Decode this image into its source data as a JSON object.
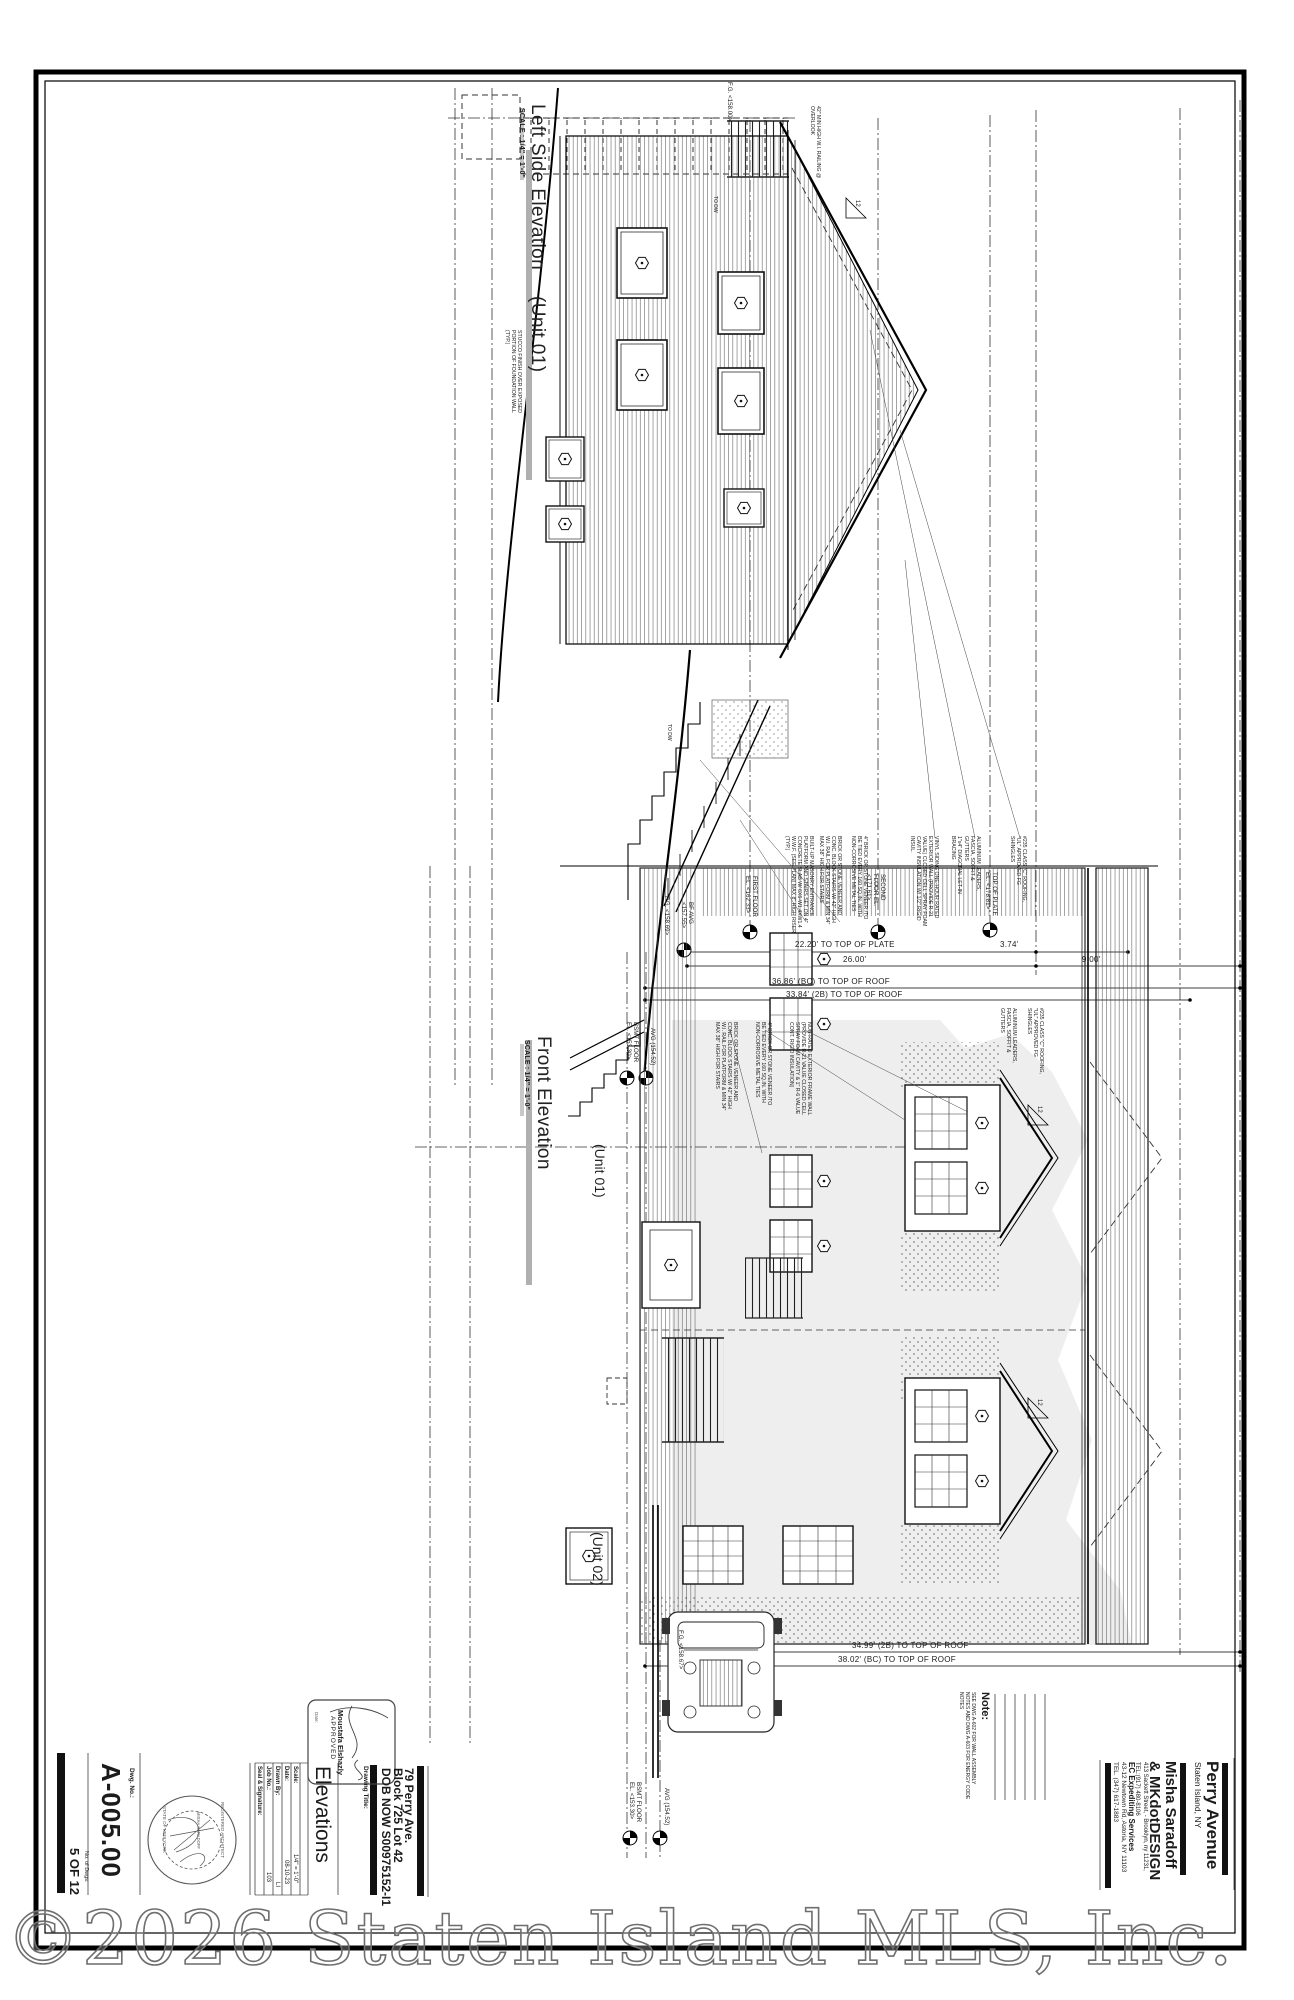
{
  "colors": {
    "ink": "#1b1b1b",
    "silhouette": "#e0e0e0",
    "watermark_gray": "#6e6e6e"
  },
  "watermark": "©2026 Staten Island MLS, Inc.",
  "elevations": {
    "left": {
      "title": "Left Side Elevation",
      "unit": "(Unit 01)",
      "scale": "SCALE : 1/4\" = 1'-0\""
    },
    "front": {
      "title": "Front Elevation",
      "scale": "SCALE : 1/4\" = 1'-0\"",
      "unit1": "(Unit 01)",
      "unit2": "(Unit 02)"
    }
  },
  "dims": {
    "plate": "22.20' TO TOP OF PLATE",
    "overall": "26.00'",
    "bc_roof": "36.86' (BC) TO TOP OF ROOF",
    "b2_roof": "33.84' (2B) TO TOP OF ROOF",
    "d374": "3.74'",
    "d900": "9.00'",
    "front_2b": "34.99' (2B) TO TOP OF ROOF",
    "front_bc": "38.02' (BC) TO TOP OF ROOF"
  },
  "levels": {
    "first": "FIRST FLOOR EL. <162.33>",
    "second": "SECOND FLOOR EL. <171.61>",
    "plate": "TOP OF PLATE EL. <178.81>",
    "bf_avg": "BF AVG <157.55>",
    "fg1": "F.G. <158.69>",
    "fg2": "F.G. <158.67>",
    "fg_top": "F.G. <158.00>",
    "bsmt": "BSMT FLOOR EL. <153.30>",
    "avg": "AVG (154.52)"
  },
  "slope": "12",
  "callouts": {
    "masonry": "BUILT-UP MASONRY ENTRANCE PLATFORM AND STAIRS SET ON 4\" CONCRETE SLAB W/ 6X6-W1.4XW1.4 W.W.F. (SEE PLAN) MAX 8\" HIGH RISER (TYP.)",
    "stairs": "BRICK OR STONE VENEER AND CONC. BLOCK STAIRS W/ 42\" HIGH W.I. RAIL FOR PLATFORM & MIN 34\" MAX 38\" HIGH FOR STAIRS",
    "veneer": "4\" BRICK OR STONE VENEER /TO BE TIED EVERY 160 SQ.IN. WITH NON-CORROSIVE METAL TIES",
    "siding": "VINYL SIDING ONE-HOUR RATED EXTERIOR WALL (PROVIDE R-21 VALUE) CLOSED CELL SPRAY FOAM CAVITY INSULATION W/ 1/2\" RIGID INSUL.",
    "bracing": "1\"x4\" DIAGONAL LET-IN BRACING",
    "leaders": "ALUMINUM LEADERS, FASCIA, SOFFIT & GUTTERS",
    "roofing": "#235 CLASS \"C\" ROOFING, \"UL\" APPROVED FG SHINGLES",
    "frame_wall": "NON-RATED EXTERIOR FRAME WALL (PROVIDE R-21 VALUE CLOSED CELL SPRAY FOAM CAVITY & 1\" R-6 VALUE CONT. RIGID INSULATION)",
    "stucco": "STUCCO FINISH OVER EXPOSED PORTION OF FOUNDATION WALL (TYP.)",
    "railing": "42\" MIN HIGH W.I. RAILING @ OVERLOOK",
    "to_dw": "TO DW"
  },
  "titleblock": {
    "dwg_no_label": "Dwg. No.:",
    "dwg_no": "A-005.00",
    "num_dwgs_label": "No. of Dwgs:",
    "num_dwgs": "5 OF 12",
    "seal_label": "Seal & Signature:",
    "job_label": "Job No.:",
    "job": "103",
    "drawn_label": "Drawn By:",
    "drawn": "LI",
    "date_label": "Date:",
    "date": "08-10-23",
    "scale_label": "Scale:",
    "scale": "1/4\" = 1'-0\"",
    "title_label": "Drawing Title:",
    "title": "Elevations",
    "seal": {
      "l1": "REGISTERED ARCHITECT",
      "l2": "STATE OF NEW YORK",
      "l3": "MISHA SARADOFF"
    },
    "stamp": {
      "name": "Moustafa Elshazly",
      "status": "APPROVED",
      "date_label": "Date:"
    },
    "project": {
      "l1": "79 Perry Ave.",
      "l2": "Block 725 Lot 42",
      "l3": "DOB NOW S00975152-I1"
    },
    "note_label": "Note:",
    "note": "SEE DWG A-602 FOR WALL ASSEMBLY NOTES AND DWG A-603 FOR ENERGY CODE NOTES",
    "expediter": {
      "name": "EC Expediting Services",
      "addr": "43-12 Newtown Rd, Astoria, NY 11103",
      "tel": "TEL. (347) 617-1883"
    },
    "firm": {
      "name1": "Misha Saradoff",
      "name2": "& MKdotDESIGN",
      "addr": "413 Sackett Street, - Brooklyn, ny 11231,",
      "tel": "TEL:(917) 480-8106"
    },
    "project_name": {
      "name": "Perry Avenue",
      "city": "Staten Island, NY"
    }
  }
}
